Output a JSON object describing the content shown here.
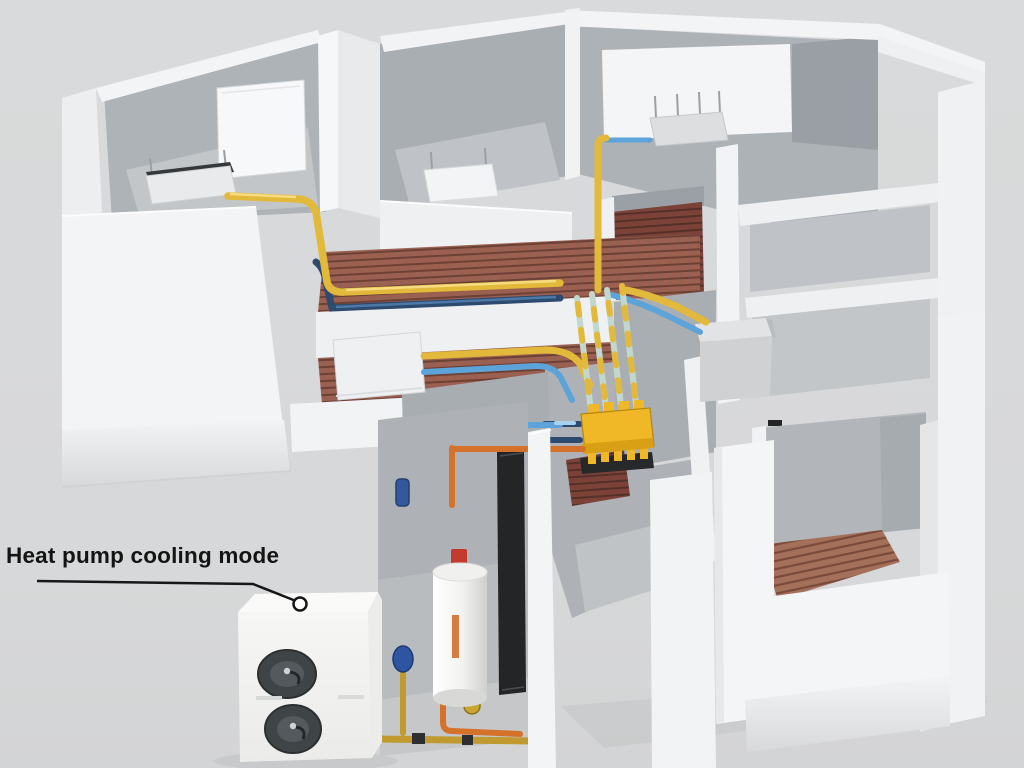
{
  "annotation": {
    "label": "Heat pump cooling mode"
  },
  "colors": {
    "background": "#d8d9da",
    "ground_shadow": "#c7c9ca",
    "wall_white": "#f3f4f5",
    "wall_lit": "#f7f8f9",
    "wall_shade": "#e9ebec",
    "interior_gray": "#adb2b6",
    "interior_gray_dark": "#9aa0a5",
    "floor_gray": "#c2c5c8",
    "pipe_supply_yellow": "#e2b93b",
    "pipe_supply_yellow_dark": "#a8851b",
    "pipe_return_blue": "#5ba3d9",
    "pipe_return_blue_dark": "#2e4a6e",
    "pipe_dhw_orange": "#d4712a",
    "pipe_brass": "#c09a2e",
    "pipe_black": "#27292b",
    "pipe_insulation": "#c3d8cd",
    "manifold_yellow": "#f0b827",
    "manifold_base_dark": "#26282a",
    "underfloor_coil_base": "#9c6050",
    "underfloor_coil_line": "#6d4034",
    "underfloor_coil_dark_base": "#7c4238",
    "underfloor_coil_dark_line": "#55302a",
    "underfloor_coil_br_base": "#a4705a",
    "underfloor_coil_br_line": "#7a4a3a",
    "fan_dark": "#3f4447",
    "tank_red_valve": "#c23b2c",
    "expansion_vessel_blue": "#2d55a0",
    "label_color": "#141414"
  }
}
